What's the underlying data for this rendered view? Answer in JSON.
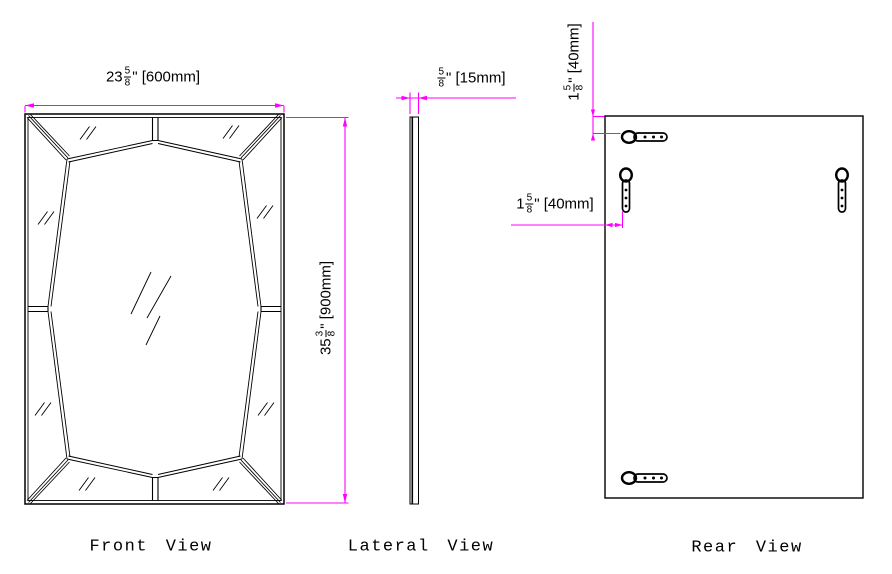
{
  "labels": {
    "front": "Front View",
    "lateral": "Lateral View",
    "rear": "Rear View"
  },
  "dims": {
    "front_width": {
      "whole": "23",
      "num": "5",
      "den": "8",
      "rest": "\" [600mm]"
    },
    "front_height": {
      "whole": "35",
      "num": "3",
      "den": "8",
      "rest": "\" [900mm]"
    },
    "lateral_thickness": {
      "whole": "",
      "num": "5",
      "den": "8",
      "rest": "\" [15mm]"
    },
    "rear_top_offset": {
      "whole": "1",
      "num": "5",
      "den": "8",
      "rest": "\" [40mm]"
    },
    "rear_left_offset": {
      "whole": "1",
      "num": "5",
      "den": "8",
      "rest": "\" [40mm]"
    }
  },
  "colors": {
    "dimension": "#FF00FF",
    "line": "#000000",
    "background": "#FFFFFF"
  }
}
